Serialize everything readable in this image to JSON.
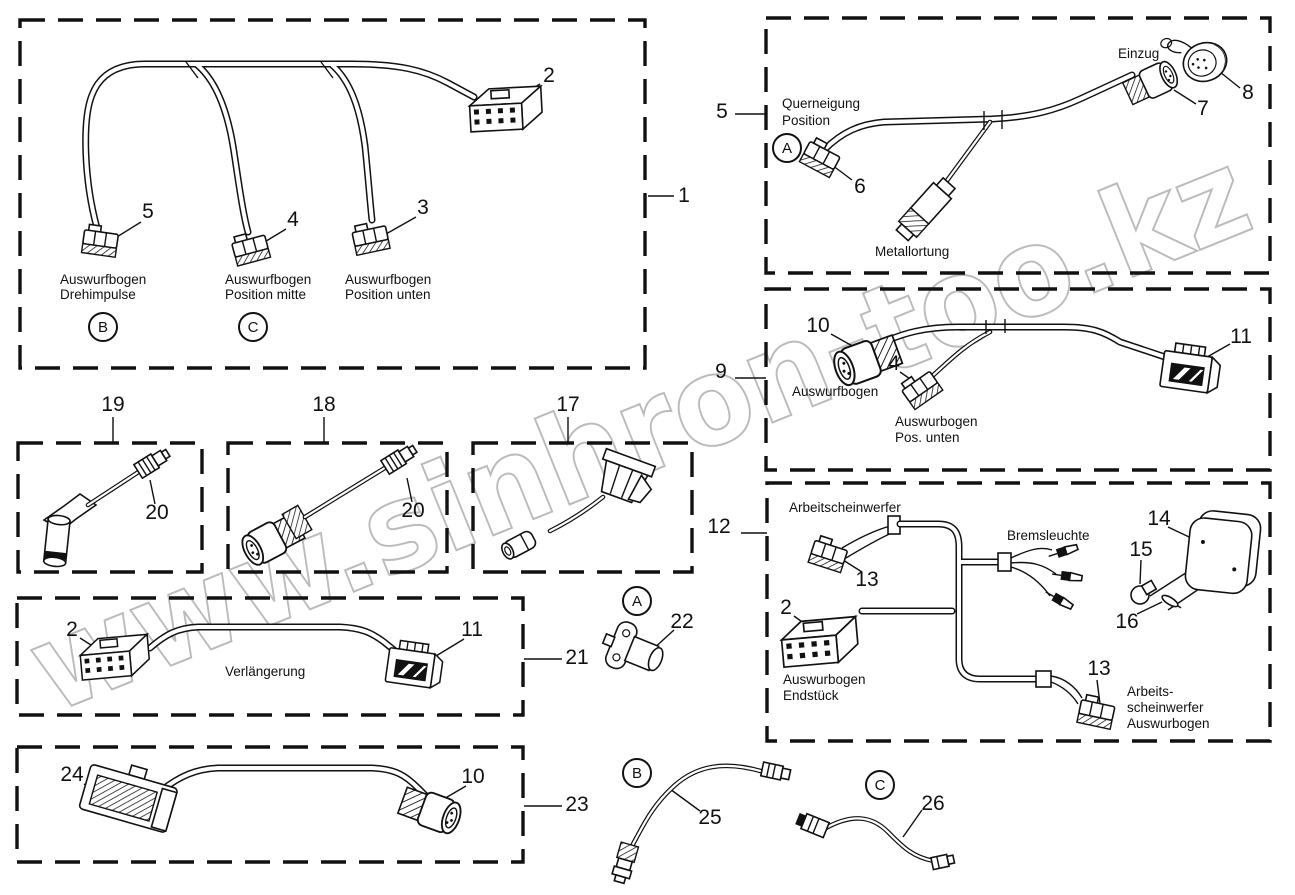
{
  "watermark": {
    "text": "www.sinhron-too.kz"
  },
  "figures": {
    "box1": {
      "callout": "1",
      "n2": "2",
      "n5": "5",
      "n4": "4",
      "n3": "3",
      "cap1l1": "Auswurfbogen",
      "cap1l2": "Drehimpulse",
      "letterB": "B",
      "cap2l1": "Auswurfbogen",
      "cap2l2": "Position mitte",
      "letterC": "C",
      "cap3l1": "Auswurfbogen",
      "cap3l2": "Position unten"
    },
    "box5": {
      "callout": "5",
      "n6": "6",
      "n7": "7",
      "n8": "8",
      "letterA": "A",
      "cap1l1": "Querneigung",
      "cap1l2": "Position",
      "capEinzug": "Einzug",
      "capMetall": "Metallortung"
    },
    "box9": {
      "callout": "9",
      "n10": "10",
      "n4": "4",
      "n11": "11",
      "cap1": "Auswurfbogen",
      "cap2l1": "Auswurbogen",
      "cap2l2": "Pos. unten"
    },
    "box12": {
      "callout": "12",
      "n13a": "13",
      "n13b": "13",
      "n2": "2",
      "n14": "14",
      "n15": "15",
      "n16": "16",
      "capArb": "Arbeitscheinwerfer",
      "capBrems": "Bremsleuchte",
      "capEnd1": "Auswurbogen",
      "capEnd2": "Endstück",
      "capArb2l1": "Arbeits-",
      "capArb2l2": "scheinwerfer",
      "capArb2l3": "Auswurbogen"
    },
    "box19": {
      "callout": "19",
      "n20": "20"
    },
    "box18": {
      "callout": "18",
      "n20": "20"
    },
    "box17": {
      "callout": "17"
    },
    "box21": {
      "callout": "21",
      "n2": "2",
      "n11": "11",
      "capVerl": "Verlängerung"
    },
    "box23": {
      "callout": "23",
      "n24": "24",
      "n10": "10"
    },
    "loose": {
      "letterA": "A",
      "n22": "22",
      "letterB": "B",
      "n25": "25",
      "letterC": "C",
      "n26": "26"
    }
  }
}
